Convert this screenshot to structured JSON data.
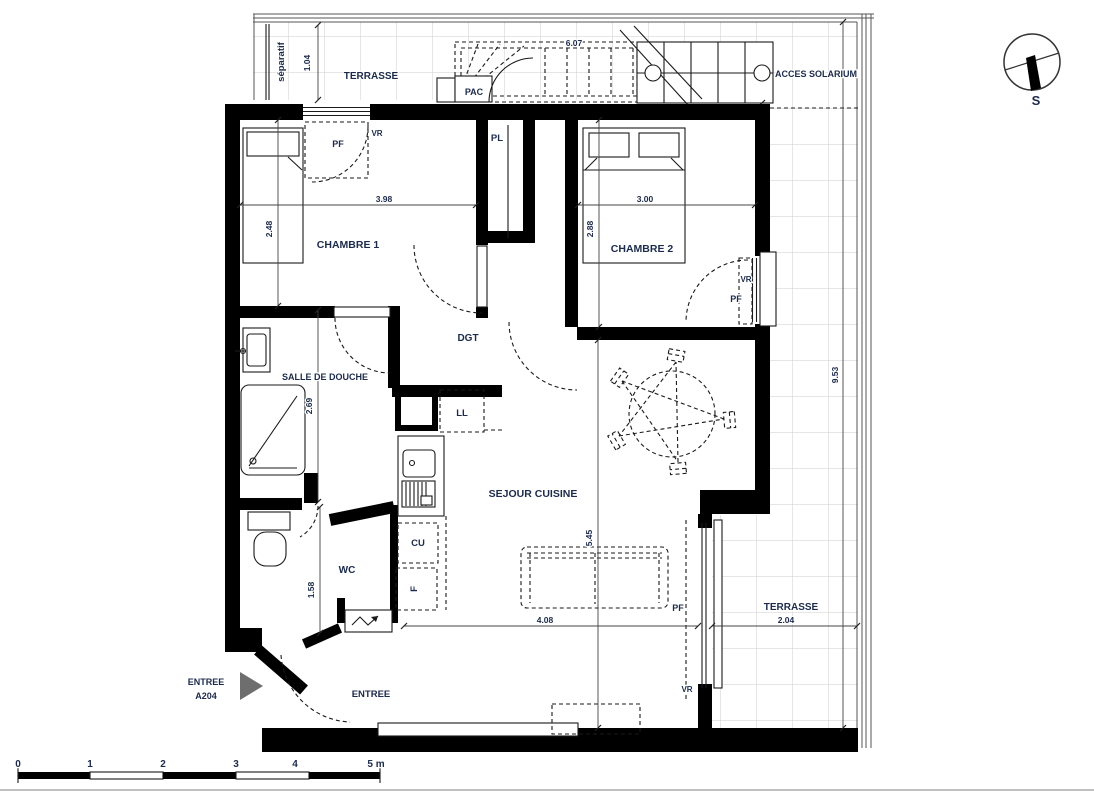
{
  "plan": {
    "rooms": {
      "terrasse_top": "TERRASSE",
      "terrasse_right": "TERRASSE",
      "chambre1": "CHAMBRE 1",
      "chambre2": "CHAMBRE 2",
      "sdb": "SALLE DE DOUCHE",
      "wc": "WC",
      "dgt": "DGT",
      "sejour": "SEJOUR CUISINE",
      "pl": "PL",
      "entree": "ENTREE"
    },
    "dimensions": {
      "c1_w": "3.98",
      "c1_h": "2.48",
      "c2_w": "3.00",
      "c2_h": "2.88",
      "sdb_h": "2.69",
      "wc_h": "1.58",
      "sej_h": "5.45",
      "sej_w": "4.08",
      "ter_top_d": "1.04",
      "stairs_l": "6.07",
      "ter_right_w": "2.04",
      "ter_right_h": "9.53"
    },
    "equipment": {
      "pac": "PAC",
      "ll": "LL",
      "cu": "CU",
      "f": "F"
    },
    "window_labels": {
      "c1_vr": "VR",
      "c1_pf": "PF",
      "c2_vr": "VR",
      "c2_pf": "PF",
      "sej_pf": "PF",
      "sej_vr": "VR"
    },
    "annotations": {
      "separatif": "séparatif",
      "acces_solarium": "ACCES SOLARIUM",
      "entree_ref_line1": "ENTREE",
      "entree_ref_line2": "A204",
      "compass_south": "S"
    },
    "scale_bar": {
      "t0": "0",
      "t1": "1",
      "t2": "2",
      "t3": "3",
      "t4": "4",
      "t5": "5 m"
    },
    "colors": {
      "wall": "#000000",
      "label_text": "#1c2b4a",
      "grid": "#cdcdcd",
      "entry_arrow": "#6e6e6e"
    }
  }
}
